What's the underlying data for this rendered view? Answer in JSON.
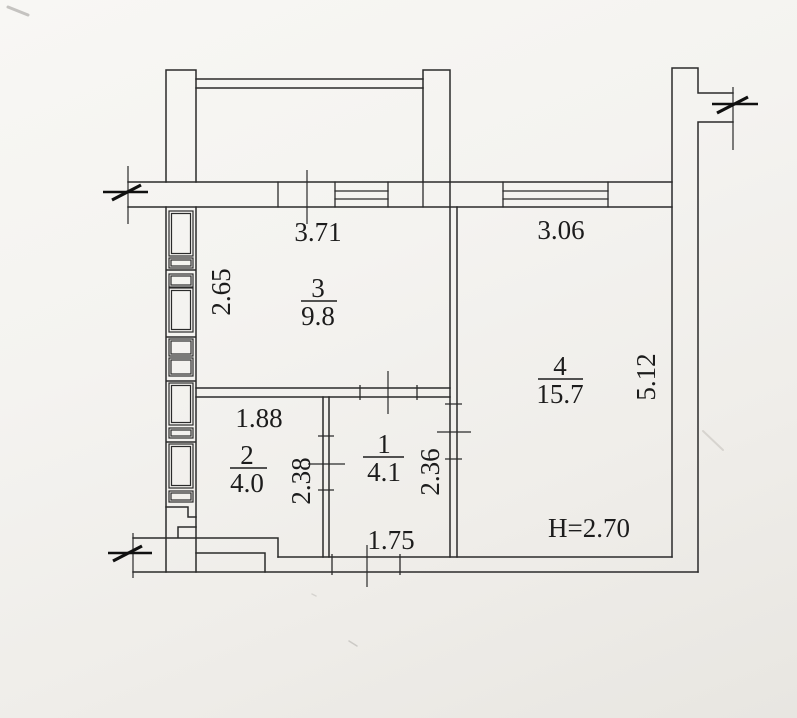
{
  "rooms": {
    "r1": {
      "number": "1",
      "area": "4.1"
    },
    "r2": {
      "number": "2",
      "area": "4.0"
    },
    "r3": {
      "number": "3",
      "area": "9.8"
    },
    "r4": {
      "number": "4",
      "area": "15.7"
    }
  },
  "dimensions": {
    "top_room3_width": "3.71",
    "top_room4_width": "3.06",
    "left_wall_height": "2.65",
    "room2_width": "1.88",
    "room2_height": "2.38",
    "room1_bottom_width": "1.75",
    "room1_height": "2.36",
    "room4_height": "5.12",
    "ceiling_height": "H=2.70"
  },
  "colors": {
    "line": "#2b2b2b",
    "paper": "#f3f2ef"
  }
}
